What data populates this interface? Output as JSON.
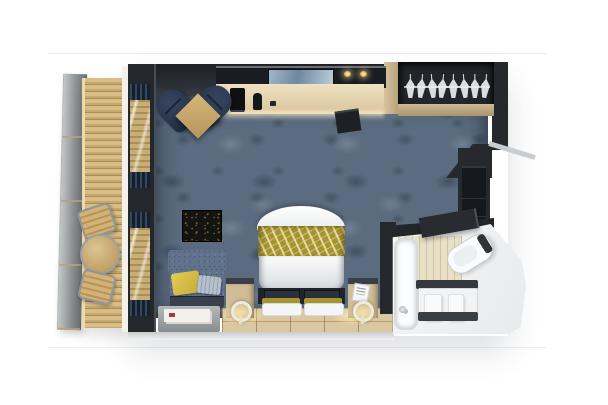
{
  "scene": {
    "type": "3D top-down floor plan rendering",
    "subject": "Cruise ship balcony stateroom",
    "rooms": [
      {
        "name": "balcony",
        "items": [
          "privacy divider door panel",
          "wood plank decking",
          "round bistro table",
          "deck chair",
          "deck chair"
        ]
      },
      {
        "name": "living-bedroom",
        "items": [
          "sliding glass doors with curtains",
          "navy armchair",
          "navy armchair",
          "square corner table",
          "vanity desk with backlit mirror",
          "coffee machine",
          "kettle",
          "stool",
          "bed with white duvet and gold floral runner",
          "pillow set",
          "pillow set",
          "under-bed storage niche",
          "nightstand",
          "nightstand",
          "round reading lamp",
          "round reading lamp",
          "sofa with yellow and grey cushions",
          "dark floral wall art",
          "grey magazine table",
          "blue-grey carpet",
          "tiled floor strip along foot wall"
        ]
      },
      {
        "name": "wardrobe",
        "items": [
          "open closet rail",
          "hanger",
          "hanger",
          "hanger",
          "hanger",
          "hanger",
          "hanger",
          "hanger",
          "hanger",
          "beige shelf",
          "minibar cabinet"
        ]
      },
      {
        "name": "bathroom",
        "items": [
          "bathtub shower with faucet",
          "angled toilet",
          "vanity counter and cabinet",
          "towel rail",
          "white towel",
          "white towel",
          "open dark door",
          "beige shower wall"
        ]
      }
    ],
    "hanger_count": 8
  },
  "palette": {
    "bg": "#ffffff",
    "line": "#ececec",
    "wood-edge": "#ecdaa9",
    "wall": "#24282d",
    "carpet": "#5b6c80",
    "gold": "#a5942f",
    "tile": "#d9c8a0"
  }
}
